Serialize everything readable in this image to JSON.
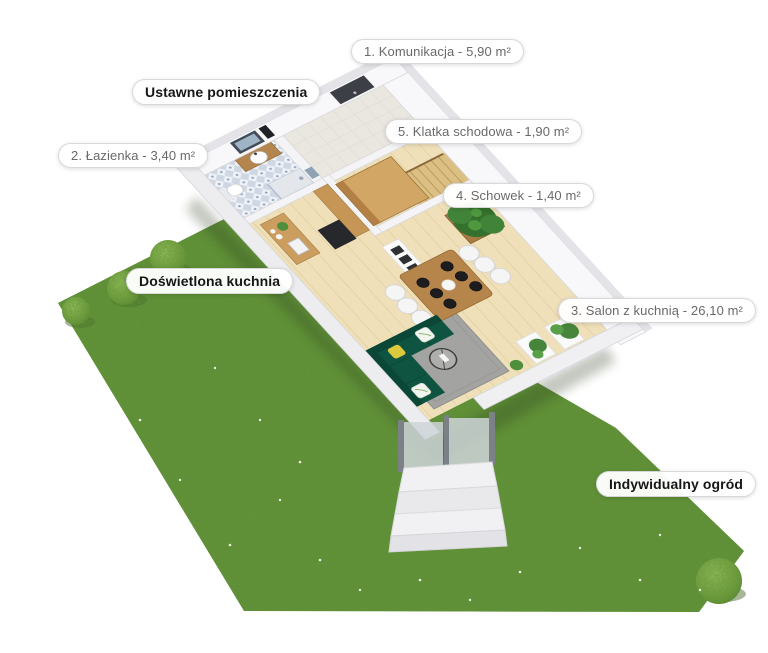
{
  "labels": {
    "komunikacja": "1. Komunikacja - 5,90 m²",
    "ustawne": "Ustawne pomieszczenia",
    "klatka": "5. Klatka schodowa - 1,90 m²",
    "lazienka": "2. Łazienka - 3,40 m²",
    "schowek": "4. Schowek - 1,40 m²",
    "kuchnia": "Doświetlona kuchnia",
    "salon": "3. Salon z kuchnią - 26,10 m²",
    "ogrod": "Indywidualny ogród"
  },
  "colors": {
    "grass": "#5e8d31",
    "bush": "#93bf52",
    "wall_white": "#f8f8fa",
    "wall_top": "#e3e3e8",
    "floor_wood": "#efe0ba",
    "furniture_wood": "#c59655",
    "sofa_green": "#0e5440",
    "rug_gray": "#a3a3a1",
    "tile_blue": "#cfd7e3",
    "label_text_area": "#696969",
    "label_text_feature": "#161616",
    "label_border": "#d8d8d8"
  }
}
